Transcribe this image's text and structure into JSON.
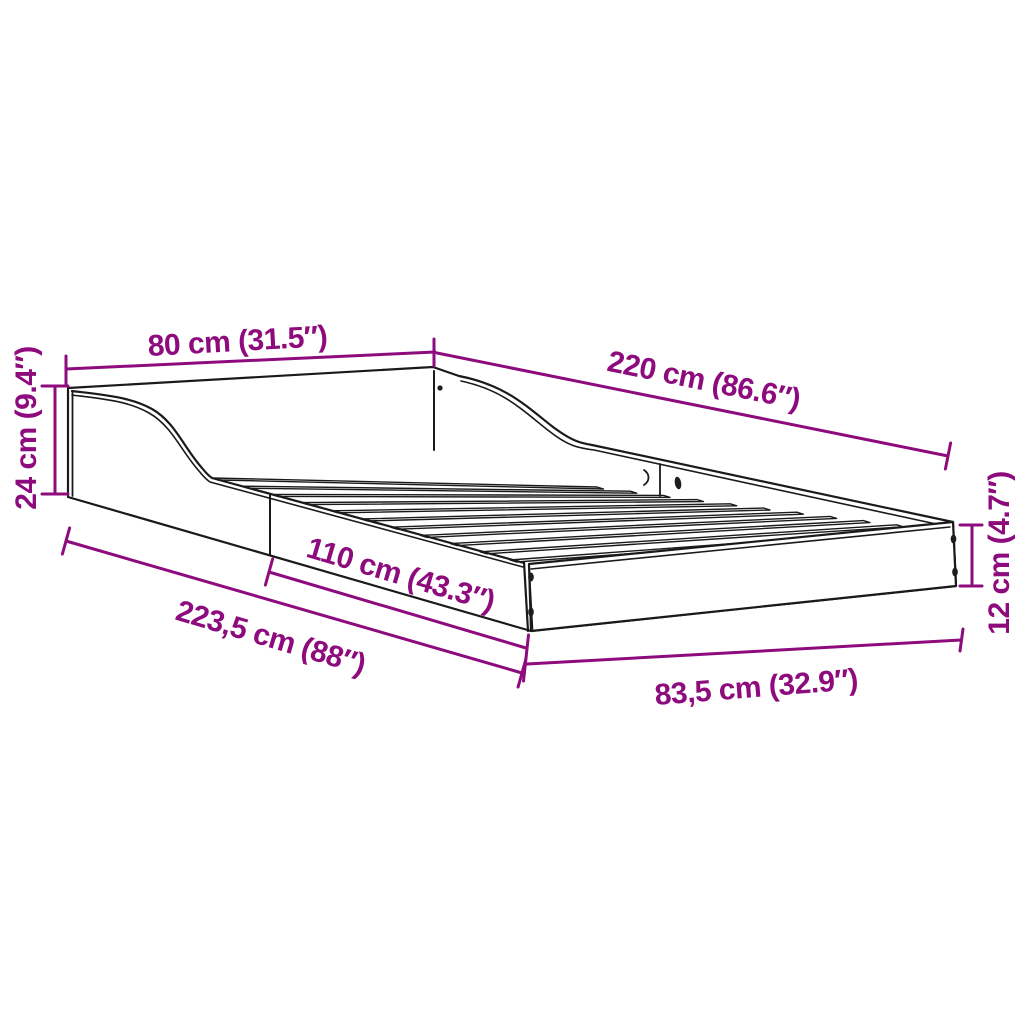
{
  "diagram": {
    "subject": "bed-frame",
    "accent_color": "#8d0b7d",
    "line_color": "#1a1a1a",
    "dimensions": {
      "width_head": "80 cm (31.5″)",
      "length_side": "220 cm (86.6″)",
      "height_head": "24 cm (9.4″)",
      "side_rail": "110 cm (43.3″)",
      "length_total": "223,5 cm (88″)",
      "width_foot": "83,5 cm (32.9″)",
      "height_foot": "12 cm (4.7″)"
    }
  }
}
